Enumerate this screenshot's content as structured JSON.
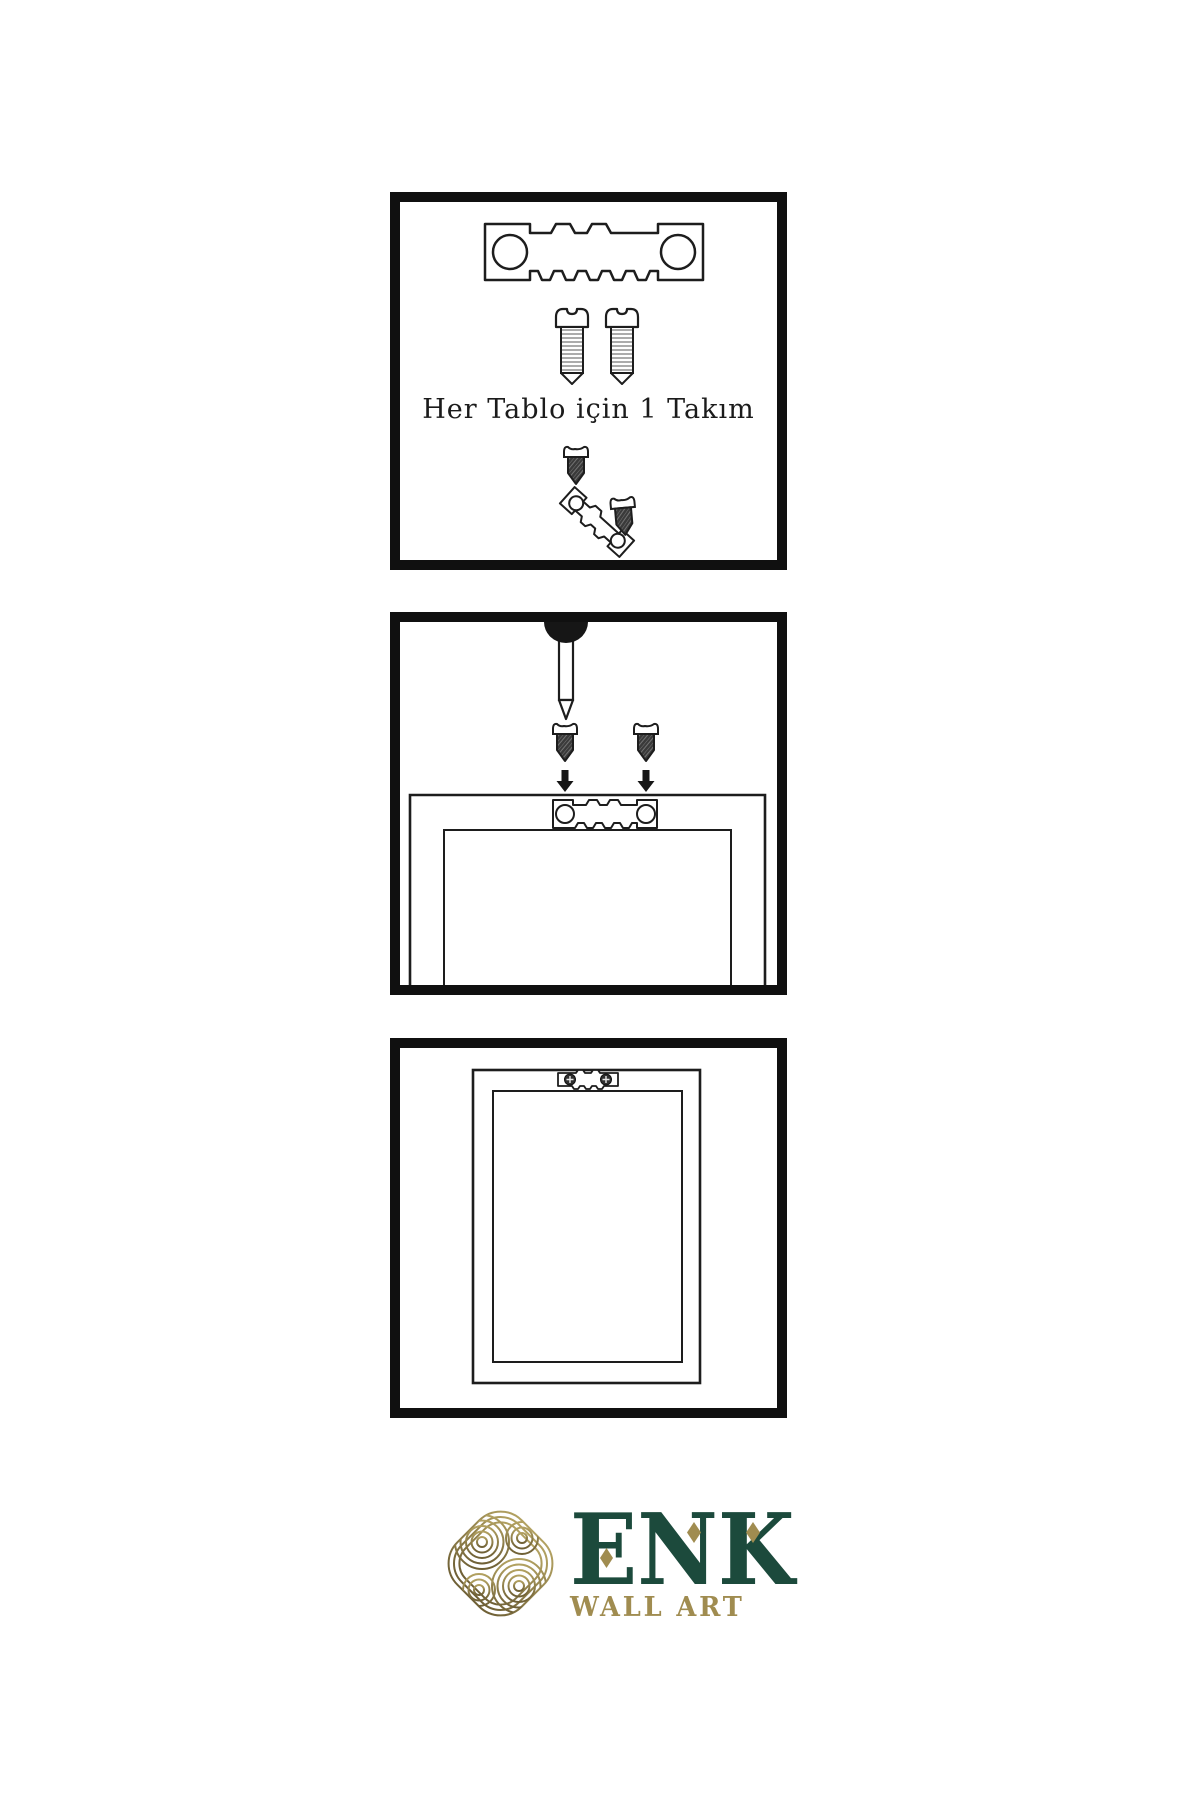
{
  "page": {
    "background": "#ffffff"
  },
  "panel1": {
    "caption": "Her Tablo için 1 Takım"
  },
  "brand": {
    "name": "ENK",
    "tagline": "WALL ART"
  },
  "colors": {
    "line_art": "#1d1d1d",
    "panel_border": "#101010",
    "screw_dark_fill": "#3a3a3a",
    "nail_shadow": "#161616",
    "brand_green": "#1c4a3c",
    "brand_gold": "#a08c50",
    "knot_gold_light": "#b2a161",
    "knot_gold_dark": "#6f6036"
  },
  "icons": {
    "sawtooth-hanger-icon": "metal hanger plate with two round holes and sawtooth edge",
    "screw-outline-icon": "threaded screw outline with slotted dome head",
    "screw-dark-icon": "small dark screw with hatched body",
    "nail-icon": "nail driven downward from wall top",
    "arrow-down-icon": "▼",
    "picture-frame-back-icon": "nested rectangles (frame back)",
    "picture-frame-front-icon": "nested rectangles (framed art on wall)",
    "knot-logo-icon": "interlaced knot of concentric gold lines",
    "diamond-accent-icon": "◆"
  }
}
